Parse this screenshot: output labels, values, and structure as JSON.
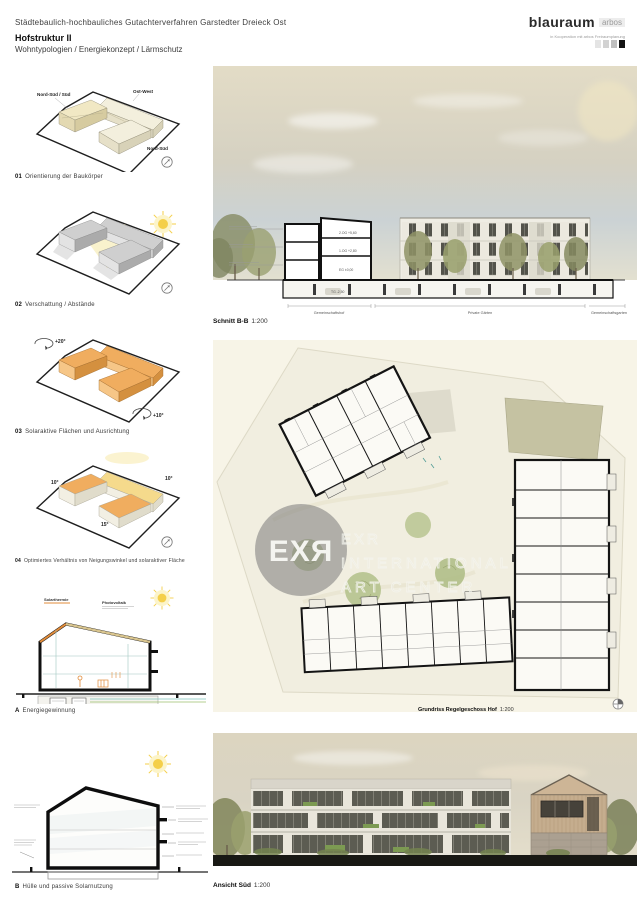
{
  "header": {
    "project_line": "Städtebaulich-hochbauliches Gutachterverfahren Garstedter Dreieck Ost",
    "title": "Hofstruktur II",
    "subtitle": "Wohntypologien / Energiekonzept / Lärmschutz",
    "logo": {
      "name": "blauraum",
      "partner": "arbos",
      "subline": "in Kooperation mit arbos Freiraumplanung",
      "swatches": [
        "#e4e4e4",
        "#d2d2d2",
        "#bfbfbf",
        "#121212"
      ]
    }
  },
  "diagrams": [
    {
      "num": "01",
      "caption": "Orientierung der Baukörper",
      "labels": {
        "left": "Nord-Süd / Süd",
        "top": "Ost-West",
        "right": "Nord-Süd"
      }
    },
    {
      "num": "02",
      "caption": "Verschattung / Abstände"
    },
    {
      "num": "03",
      "caption": "Solaraktive Flächen und Ausrichtung",
      "labels": {
        "rot_top": "+20°",
        "rot_bottom": "+10°"
      }
    },
    {
      "num": "04",
      "caption": "Optimiertes Verhältnis von Neigungswinkel und solaraktiver Fläche",
      "labels": {
        "roof_left": "10°",
        "roof_mid": "15°",
        "roof_right": "10°"
      }
    },
    {
      "num": "A",
      "caption": "Energiegewinnung",
      "labels": {
        "roof_left": "Solarthermie",
        "roof_right": "Photovoltaik"
      }
    },
    {
      "num": "B",
      "caption": "Hülle und passive Solarnutzung"
    }
  ],
  "panels": {
    "section": {
      "name": "Schnitt B-B",
      "scale": "1:200",
      "levels": [
        "2.OG +5,60",
        "1.OG +2,80",
        "EG ±0,00",
        "TG -2,50"
      ],
      "zones": [
        "Gemeinschaftshof",
        "Private Gärten",
        "Gemeinschaftsgarten"
      ]
    },
    "plan": {
      "name": "Grundriss Regelgeschoss Hof",
      "scale": "1:200"
    },
    "elevation": {
      "name": "Ansicht Süd",
      "scale": "1:200"
    }
  },
  "watermark": {
    "badge": "EXЯ",
    "line1": "EXR",
    "line2": "INTERNATIONAL",
    "line3": "ART CENTER"
  },
  "icons": {
    "sun-icon": "yellow circle with rays",
    "north-arrow-icon": "small circled arrow",
    "plan-north-icon": "circle with cross"
  },
  "colors": {
    "accent_orange": "#f0ad5f",
    "accent_yellow": "#f5da8c",
    "sun_yellow": "#f4cf4a",
    "plan_paper": "#f7f4e7",
    "ground_black": "#181814"
  }
}
